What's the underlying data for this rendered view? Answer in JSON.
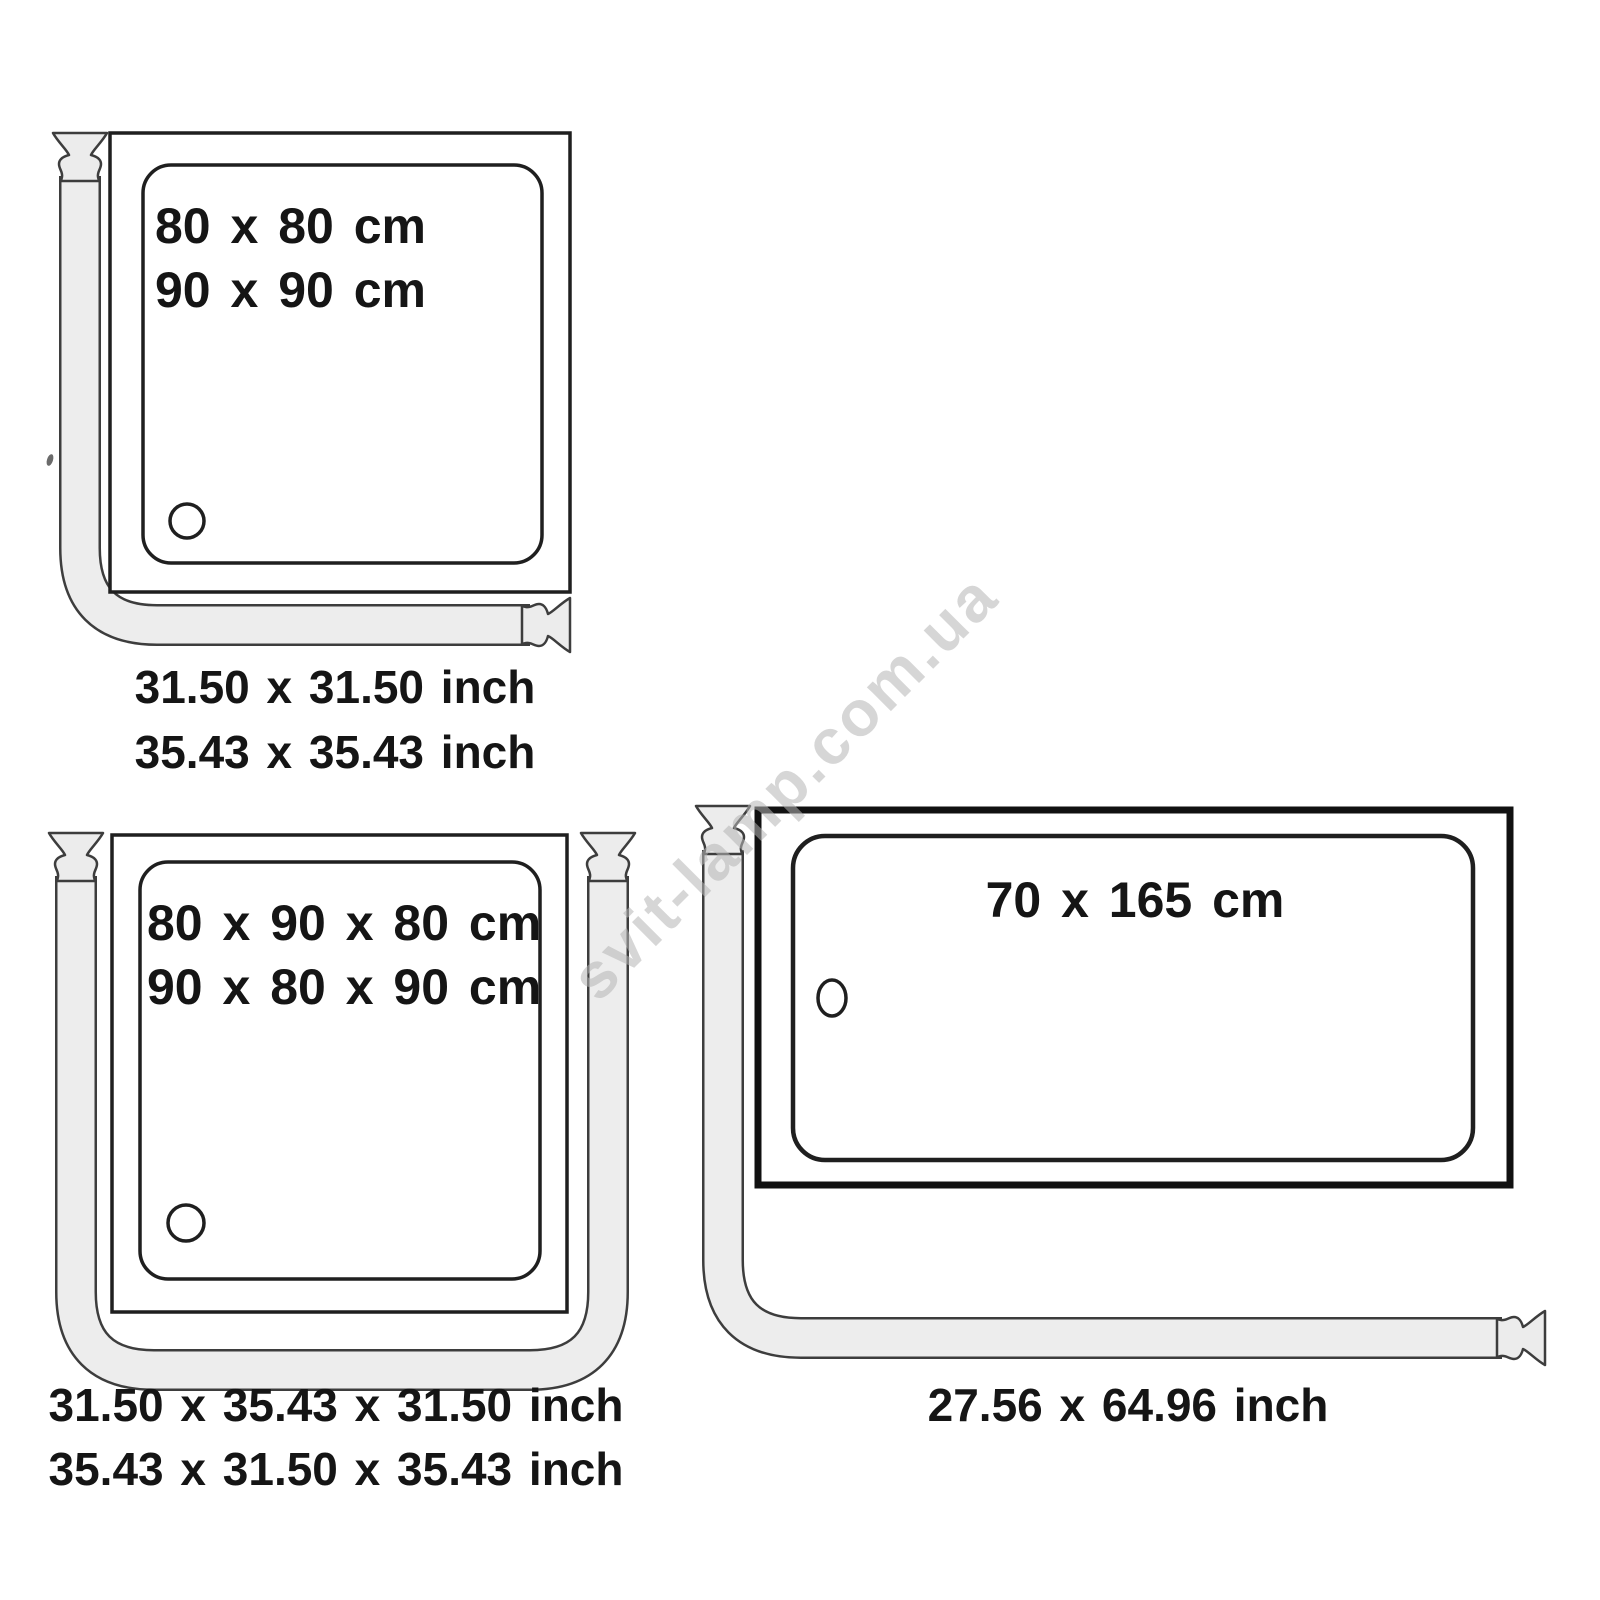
{
  "watermark": "svit-lamp.com.ua",
  "colors": {
    "line": "#1f1f1f",
    "rod_fill": "#ececec",
    "rod_outline": "#3d3d3d",
    "text": "#151515",
    "watermark": "#b5b5b5"
  },
  "diagrams": {
    "square_tray": {
      "cm_lines": [
        "80 x 80 cm",
        "90 x 90 cm"
      ],
      "inch_lines": [
        "31.50 x 31.50 inch",
        "35.43 x 35.43 inch"
      ]
    },
    "u_tray": {
      "cm_lines": [
        "80 x 90 x 80 cm",
        "90 x 80 x 90 cm"
      ],
      "inch_lines": [
        "31.50 x 35.43 x 31.50 inch",
        "35.43 x 31.50 x 35.43 inch"
      ]
    },
    "bathtub": {
      "cm_lines": [
        "70 x 165 cm"
      ],
      "inch_lines": [
        "27.56 x 64.96 inch"
      ]
    }
  }
}
